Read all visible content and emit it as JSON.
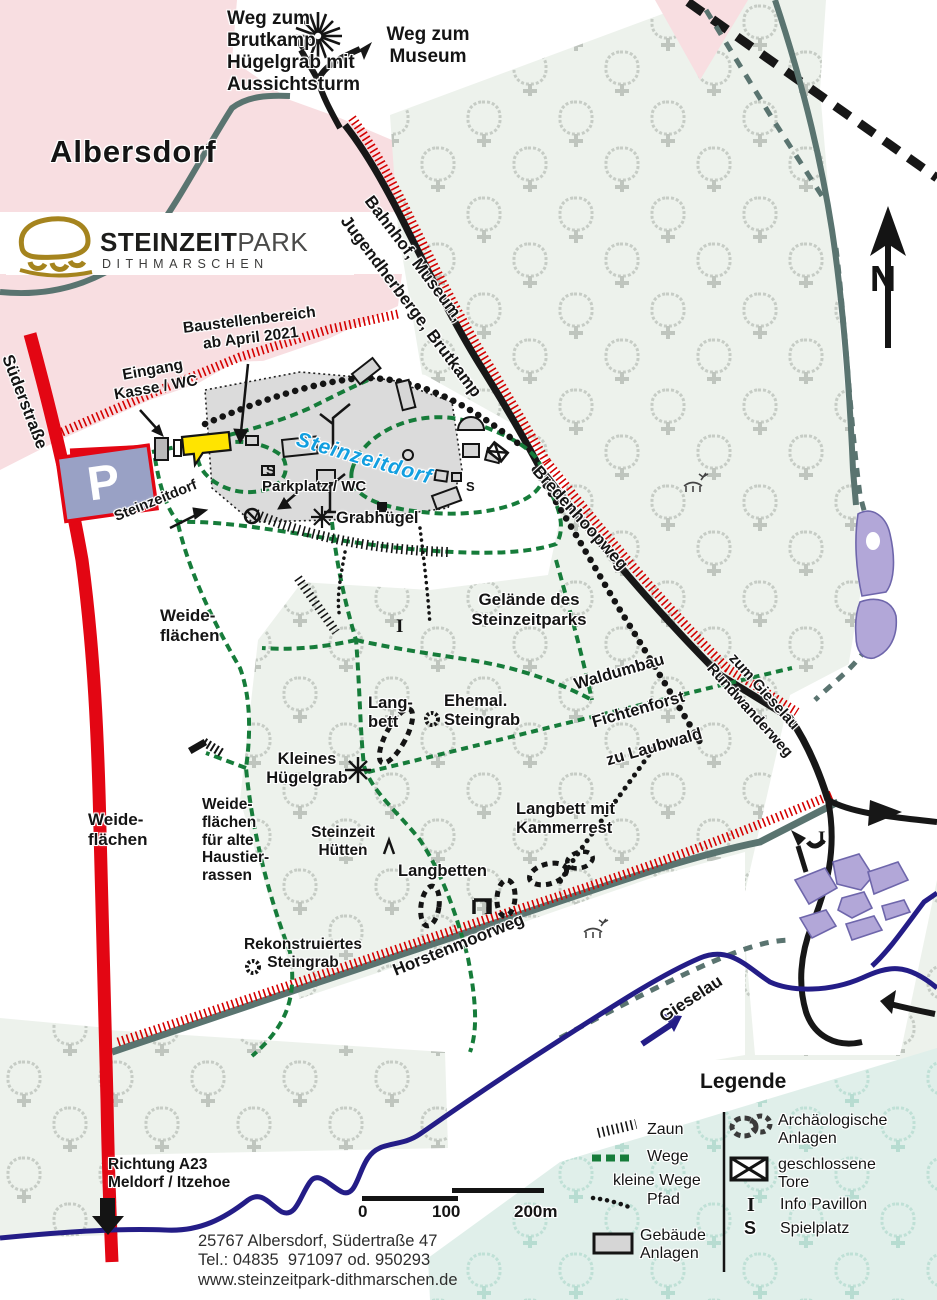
{
  "town_label": "Albersdorf",
  "logo": {
    "part1": "STEINZEIT",
    "part2": "PARK",
    "sub": "DITHMARSCHEN"
  },
  "compass": {
    "north": "N"
  },
  "parking": {
    "symbol": "P"
  },
  "directions": {
    "brutkamp": "Weg zum\nBrutkamp\nHügelgrab mit\nAussichtsturm",
    "museum": "Weg zum\nMuseum",
    "bahnhof_line1": "Bahnhof, Museum,",
    "bahnhof_line2": "Jugendherberge, Brutkamp",
    "a23": "Richtung A23\nMeldorf / Itzehoe"
  },
  "roads": {
    "suederstrasse": "Süderstraße",
    "bredenhoopweg": "Bredenhoopweg",
    "horstenmoorweg": "Horstenmoorweg",
    "gieselau_river": "Gieselau",
    "rundwanderweg_line1": "zum Gieselau",
    "rundwanderweg_line2": "Rundwanderweg"
  },
  "sites": {
    "baustelle": "Baustellenbereich\nab April 2021",
    "eingang": "Eingang\nKasse / WC",
    "steinzeitdorf": "Steinzeitdorf",
    "steinzeitdorf_small": "Steinzeitdorf",
    "parkplatz": "Parkplatz / WC",
    "grabhuegel": "Grabhügel",
    "weide1": "Weide-\nflächen",
    "weide2": "Weide-\nflächen",
    "weide3": "Weide-\nflächen\nfür alte\nHaustier-\nrassen",
    "gelaende": "Gelände des\nSteinzeitparks",
    "langbett": "Lang-\nbett",
    "ehemal": "Ehemal.\nSteingrab",
    "waldumbau_line1": "Waldumbau",
    "waldumbau_line2": "Fichtenforst",
    "waldumbau_line3": "zu Laubwald",
    "kleines": "Kleines\nHügelgrab",
    "huetten": "Steinzeit\nHütten",
    "kammerrest": "Langbett mit\nKammerrest",
    "langbetten": "Langbetten",
    "rekonstruiert": "Rekonstruiertes\nSteingrab",
    "info_i": "I",
    "spielplatz_s": "S"
  },
  "scalebar": {
    "t0": "0",
    "t100": "100",
    "t200": "200m"
  },
  "address": {
    "line1": "25767 Albersdorf, Südertraße 47",
    "line2": "Tel.: 04835  971097 od. 950293",
    "line3": "www.steinzeitpark-dithmarschen.de"
  },
  "legend": {
    "title": "Legende",
    "zaun": "Zaun",
    "wege": "Wege",
    "kleine_wege": "kleine Wege",
    "pfad": "Pfad",
    "gebaeude": "Gebäude\nAnlagen",
    "arch": "Archäologische\nAnlagen",
    "tore": "geschlossene\nTore",
    "info": "Info Pavillon",
    "spielplatz": "Spielplatz",
    "info_icon": "I",
    "spielplatz_icon": "S"
  },
  "colors": {
    "pink": "#f8dee1",
    "forest_bg": "#edf2ec",
    "forest_teal_bg": "#e0efea",
    "road_red": "#e30613",
    "road_black": "#171717",
    "road_slate": "#5a7470",
    "path_green": "#167c3a",
    "river_navy": "#241d87",
    "pond_purple": "#b2a7d8",
    "label_blue": "#129fe0",
    "logo_gold": "#a5841e",
    "building_gray": "#d6d6d6",
    "parking_fill": "#99a1c5",
    "highlight_yellow": "#ffe400"
  }
}
